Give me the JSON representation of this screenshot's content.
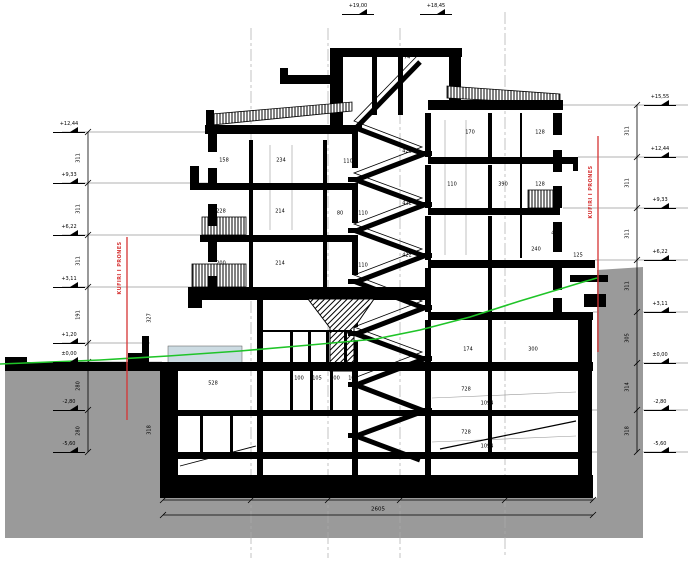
{
  "meta": {
    "drawing_type": "building cross-section (prerje)",
    "background": "#ffffff"
  },
  "colors": {
    "ink": "#000000",
    "terrain_fill": "#9a9a9a",
    "terrain_line_green": "#1fc428",
    "property_boundary_red": "#d63434",
    "entrance_ramp_fill": "#ccdbe2",
    "grid_gray": "#aaaaaa",
    "level_line_gray": "#999999"
  },
  "boundary_labels": {
    "left": "KUFIRI I PRONES",
    "right": "KUFIRI I PRONES"
  },
  "elevation_markers": {
    "left": [
      {
        "label": "+12,44",
        "y": 132
      },
      {
        "label": "+9,33",
        "y": 183
      },
      {
        "label": "+6,22",
        "y": 235
      },
      {
        "label": "+3,11",
        "y": 287
      },
      {
        "label": "+1,20",
        "y": 343
      },
      {
        "label": "±0,00",
        "y": 362
      },
      {
        "label": "-2,80",
        "y": 410
      },
      {
        "label": "-5,60",
        "y": 452
      }
    ],
    "right": [
      {
        "label": "+15,55",
        "y": 105
      },
      {
        "label": "+12,44",
        "y": 157
      },
      {
        "label": "+9,33",
        "y": 208
      },
      {
        "label": "+6,22",
        "y": 260
      },
      {
        "label": "+3,11",
        "y": 312
      },
      {
        "label": "±0,00",
        "y": 363
      },
      {
        "label": "-2,80",
        "y": 410
      },
      {
        "label": "-5,60",
        "y": 452
      }
    ],
    "top": [
      {
        "label": "+19,00",
        "x": 374,
        "y": 14
      },
      {
        "label": "+18,45",
        "x": 452,
        "y": 14
      }
    ]
  },
  "dim_chains": {
    "left": {
      "x": 88,
      "labels": [
        {
          "text": "311",
          "y": 158
        },
        {
          "text": "311",
          "y": 209
        },
        {
          "text": "311",
          "y": 261
        },
        {
          "text": "191",
          "y": 315
        },
        {
          "text": "280",
          "y": 386
        },
        {
          "text": "280",
          "y": 431
        }
      ]
    },
    "right": {
      "x": 637,
      "labels": [
        {
          "text": "311",
          "y": 131
        },
        {
          "text": "311",
          "y": 183
        },
        {
          "text": "311",
          "y": 234
        },
        {
          "text": "311",
          "y": 286
        },
        {
          "text": "305",
          "y": 338
        },
        {
          "text": "314",
          "y": 387
        },
        {
          "text": "318",
          "y": 431
        }
      ]
    },
    "bottom": {
      "segments": [
        {
          "text": "550",
          "x": 207
        },
        {
          "text": "484",
          "x": 290
        },
        {
          "text": "442",
          "x": 364
        },
        {
          "text": "614",
          "x": 452
        },
        {
          "text": "515",
          "x": 549
        }
      ],
      "total": {
        "text": "2605",
        "x": 378
      }
    }
  },
  "interior_dims": [
    {
      "text": "74",
      "x": 407,
      "y": 58
    },
    {
      "text": "158",
      "x": 224,
      "y": 161
    },
    {
      "text": "234",
      "x": 281,
      "y": 161
    },
    {
      "text": "110",
      "x": 348,
      "y": 162
    },
    {
      "text": "422",
      "x": 407,
      "y": 152
    },
    {
      "text": "170",
      "x": 470,
      "y": 133
    },
    {
      "text": "128",
      "x": 540,
      "y": 133
    },
    {
      "text": "228",
      "x": 221,
      "y": 212
    },
    {
      "text": "214",
      "x": 280,
      "y": 212
    },
    {
      "text": "80",
      "x": 340,
      "y": 214
    },
    {
      "text": "110",
      "x": 363,
      "y": 214
    },
    {
      "text": "422",
      "x": 407,
      "y": 204
    },
    {
      "text": "110",
      "x": 452,
      "y": 185
    },
    {
      "text": "390",
      "x": 503,
      "y": 185
    },
    {
      "text": "128",
      "x": 540,
      "y": 185
    },
    {
      "text": "200",
      "x": 221,
      "y": 264
    },
    {
      "text": "214",
      "x": 280,
      "y": 264
    },
    {
      "text": "110",
      "x": 363,
      "y": 266
    },
    {
      "text": "422",
      "x": 407,
      "y": 256
    },
    {
      "text": "240",
      "x": 536,
      "y": 250
    },
    {
      "text": "470",
      "x": 556,
      "y": 234
    },
    {
      "text": "125",
      "x": 578,
      "y": 256
    },
    {
      "text": "327",
      "x": 150,
      "y": 318,
      "rot": true
    },
    {
      "text": "318",
      "x": 150,
      "y": 430,
      "rot": true
    },
    {
      "text": "528",
      "x": 213,
      "y": 384
    },
    {
      "text": "100",
      "x": 299,
      "y": 379
    },
    {
      "text": "105",
      "x": 317,
      "y": 379
    },
    {
      "text": "100",
      "x": 335,
      "y": 379
    },
    {
      "text": "105",
      "x": 353,
      "y": 379
    },
    {
      "text": "174",
      "x": 468,
      "y": 350
    },
    {
      "text": "300",
      "x": 533,
      "y": 350
    },
    {
      "text": "728",
      "x": 466,
      "y": 390
    },
    {
      "text": "1094",
      "x": 487,
      "y": 404
    },
    {
      "text": "728",
      "x": 466,
      "y": 433
    },
    {
      "text": "1094",
      "x": 487,
      "y": 447
    }
  ]
}
